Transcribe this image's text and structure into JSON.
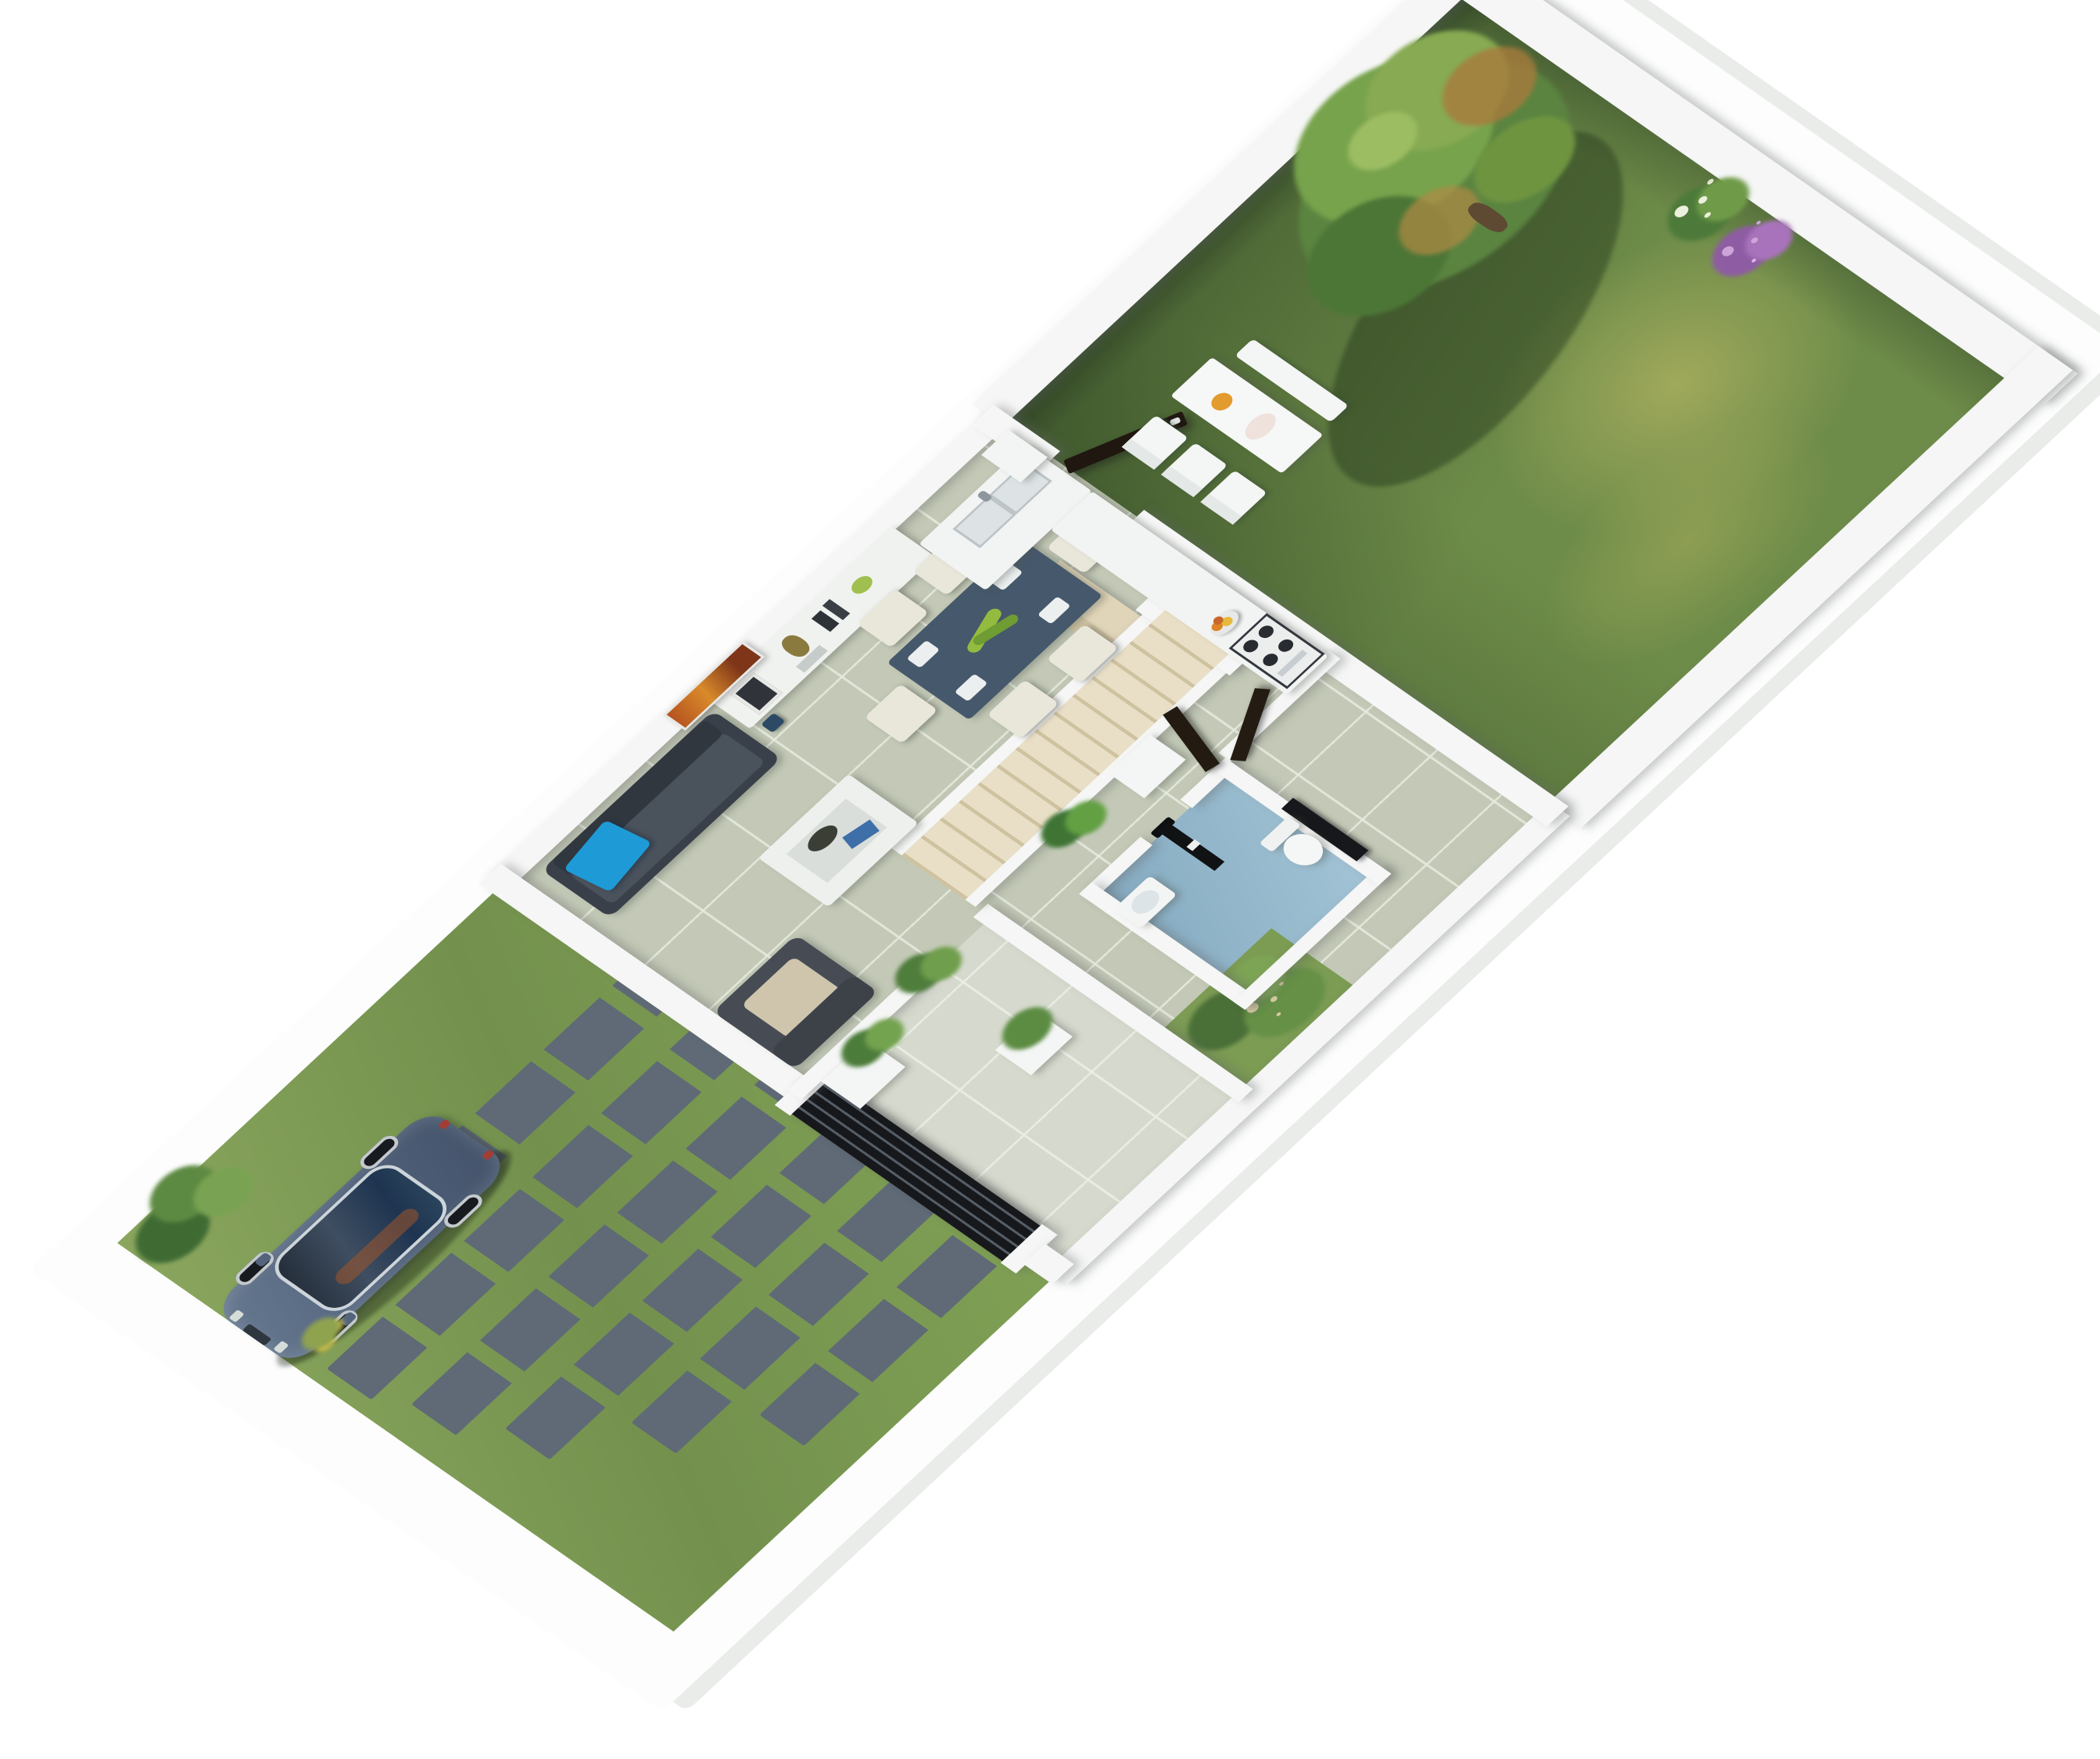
{
  "scene": {
    "description": "Photorealistic 3D isometric bird's-eye render of a narrow rectangular residential lot: front yard with parked car and stepping-stone pavers at the bottom-left, open-plan ground-floor interior in the middle, and a walled back garden with a large tree and white outdoor dining set at the top-right. No text appears in the image.",
    "view": "isometric-birdseye",
    "background_color": "#ffffff",
    "platform_color": "#fcfdfc"
  },
  "front_yard": {
    "label": "Front yard with driveway",
    "lawn_color": "#7f9e55",
    "paver_color": "#5f6a76",
    "paver_rows": 6,
    "car": {
      "label": "Parked sedan car",
      "body_color": "#5a6c82",
      "glass_color": "#2a323e",
      "interior_tint": "#8a4f2a",
      "wheel_color": "#c3c9cd",
      "facing": "street (front-left)"
    },
    "shrub_count": 2
  },
  "interior": {
    "label": "Ground floor interior",
    "wall_color": "#f5f6f5",
    "floor_tile_color": "#c3c9b6",
    "rooms": [
      {
        "label": "Living room",
        "items": [
          "charcoal sofa with bright blue accent pillow",
          "white coffee table with dark bowl and blue book",
          "gray armchair with beige cushion",
          "potted plant",
          "long white sideboard with vase, frames and green bowl",
          "orange abstract wall artwork"
        ]
      },
      {
        "label": "Dining area",
        "items": [
          "slate-blue rectangular dining table",
          "six cream upholstered chairs",
          "white place settings",
          "green leaf centerpiece"
        ]
      },
      {
        "label": "Kitchen",
        "items": [
          "white island with double sink",
          "white counter run along wall",
          "four-burner cooktop",
          "fruit bowl",
          "tall white unit",
          "dark back door standing open to garden"
        ]
      },
      {
        "label": "Staircase",
        "items": [
          "straight beige flight of stairs",
          "white stringer walls",
          "beige accent wall",
          "white cube stool"
        ]
      },
      {
        "label": "Bathroom",
        "items": [
          "steel-blue wet-room floor",
          "white washbasin",
          "white toilet",
          "black shower column"
        ]
      },
      {
        "label": "Entry porch",
        "items": [
          "black slatted entry gate with white posts",
          "white planters with green plants",
          "tiled path",
          "grass pocket with flowering shrubs"
        ]
      }
    ],
    "accent_pillow_color": "#1e9bd7",
    "dining_table_color": "#46586b",
    "chair_color": "#e9e6da",
    "bathroom_floor_color": "#84a9bf",
    "stair_color": "#e0d5b8",
    "door_color": "#241c12",
    "artwork_colors": [
      "#b5521f",
      "#d98a2b"
    ]
  },
  "back_garden": {
    "label": "Walled back garden",
    "lawn_dark_color": "#55703f",
    "lawn_light_color": "#a8a664",
    "wall_color": "#f5f6f5",
    "tree": {
      "label": "Large tree with early-autumn foliage",
      "canopy_colors": [
        "#77a34c",
        "#5a8440",
        "#a87a3c"
      ]
    },
    "outdoor_dining": {
      "label": "White outdoor dining set",
      "pieces": [
        "rectangular table",
        "three slatted chairs",
        "bench"
      ],
      "table_items": [
        "orange pitcher",
        "pale plate"
      ]
    },
    "flower_bed": {
      "label": "Corner flower bed",
      "colors": [
        "#a873bb",
        "#ecf0dc",
        "#6f9b49"
      ]
    }
  }
}
